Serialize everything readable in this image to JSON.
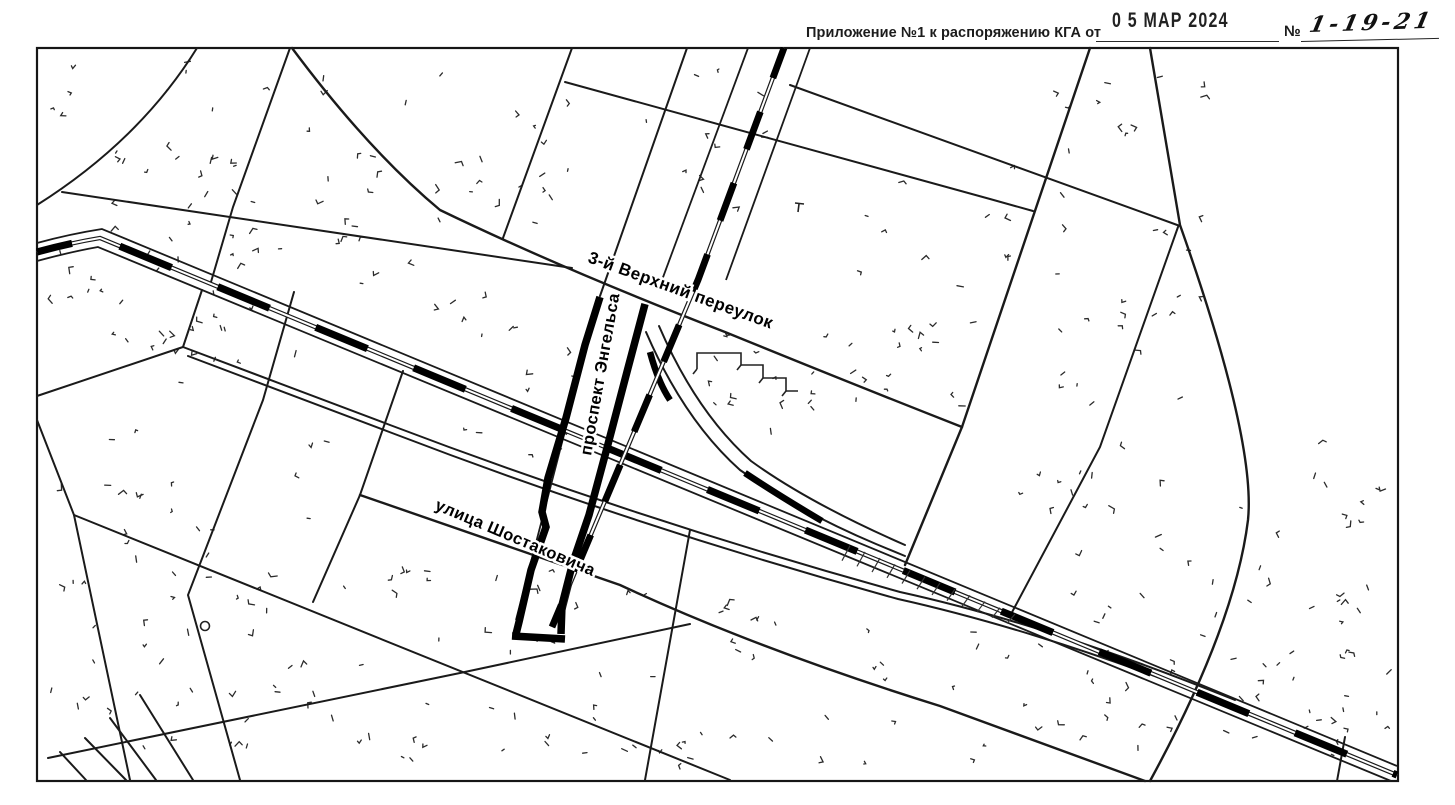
{
  "header": {
    "label": "Приложение №1 к распоряжению КГА от",
    "date_stamp": "0 5 МАР 2024",
    "number_sign": "№",
    "number_value": "1-19-21"
  },
  "map": {
    "street_labels": [
      {
        "id": "pereulok",
        "text": "3-й Верхний переулок",
        "x": 587,
        "y": 262,
        "rotate": 20,
        "size": 17
      },
      {
        "id": "engelsa",
        "text": "проспект Энгельса",
        "x": 591,
        "y": 456,
        "rotate": -80,
        "size": 16.5
      },
      {
        "id": "shostakovicha",
        "text": "улица Шостаковича",
        "x": 434,
        "y": 509,
        "rotate": 23,
        "size": 16.5
      }
    ],
    "colors": {
      "ink": "#1a1a1a",
      "bold": "#000000",
      "paper": "#ffffff"
    }
  }
}
